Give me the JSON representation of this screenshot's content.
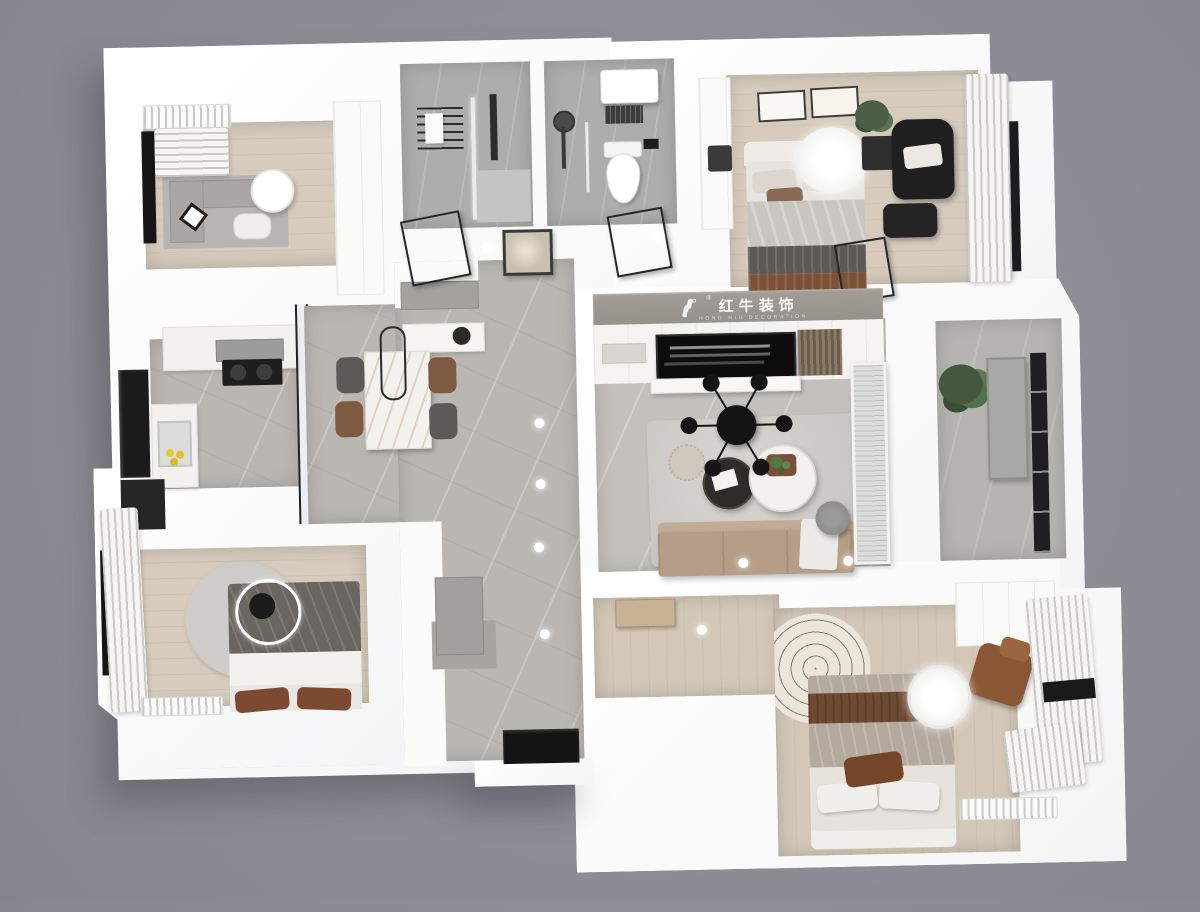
{
  "watermark": {
    "cn": "红牛装饰",
    "en": "HONG NIU DECORATION",
    "registered": "®",
    "bull_logo": "bull-icon",
    "band_color": "#9c9690"
  },
  "palette": {
    "background": "#8d8d95",
    "walls": "#fdfdfd",
    "wood_floor": "#d6cbbc",
    "tile_floor": "#bab7b3",
    "bath_floor": "#adadab",
    "sofa": "#b59d87",
    "accent_brown": "#7b4a30",
    "charcoal": "#6b6560",
    "black_furniture": "#222222",
    "plant_green": "#4a5f43",
    "lemon_yellow": "#e8c832"
  },
  "rooms": [
    {
      "id": "study",
      "furniture": [
        "l-desk",
        "desk-chair",
        "round-side-table",
        "window-blinds",
        "radiator",
        "wardrobe"
      ]
    },
    {
      "id": "bathroom-1",
      "furniture": [
        "towel-rack",
        "shower-column",
        "glass-partition"
      ]
    },
    {
      "id": "bathroom-2",
      "furniture": [
        "water-heater",
        "toilet",
        "shower-head",
        "glass-partition"
      ]
    },
    {
      "id": "master-bedroom",
      "furniture": [
        "double-bed",
        "recliner-armchair",
        "ottoman",
        "nightstand",
        "plant",
        "wall-art-frames",
        "ceiling-lamp",
        "curtain-window",
        "wardrobe"
      ]
    },
    {
      "id": "kitchen",
      "furniture": [
        "l-counter",
        "range-hood",
        "cooktop",
        "sink-with-lemons",
        "refrigerator",
        "tall-cabinet"
      ]
    },
    {
      "id": "dining-room",
      "furniture": [
        "marble-dining-table",
        "four-chairs",
        "pendant-light",
        "sideboard",
        "glass-partition"
      ]
    },
    {
      "id": "hallway",
      "furniture": [
        "console-cabinet",
        "abstract-art-frame",
        "downlights",
        "entry-door",
        "shoe-mat"
      ]
    },
    {
      "id": "living-room",
      "furniture": [
        "tv",
        "tv-cabinet-wall",
        "wood-slat-panel",
        "sputnik-chandelier",
        "round-coffee-table-black",
        "round-coffee-table-white",
        "pouf",
        "sofa",
        "floor-lamp",
        "area-rug",
        "glass-screen"
      ]
    },
    {
      "id": "balcony",
      "furniture": [
        "plant",
        "storage-panel",
        "window-wall"
      ]
    },
    {
      "id": "bedroom-2",
      "furniture": [
        "double-bed",
        "round-rug",
        "ceiling-lamp",
        "curtain-window",
        "radiator",
        "door"
      ]
    },
    {
      "id": "bedroom-3",
      "furniture": [
        "double-bed",
        "round-patterned-rug",
        "ceiling-lamp",
        "leather-armchair",
        "wardrobe",
        "curtain-window",
        "radiator",
        "wood-door"
      ]
    }
  ],
  "render_style": "3d-top-down-axonometric-floor-plan"
}
